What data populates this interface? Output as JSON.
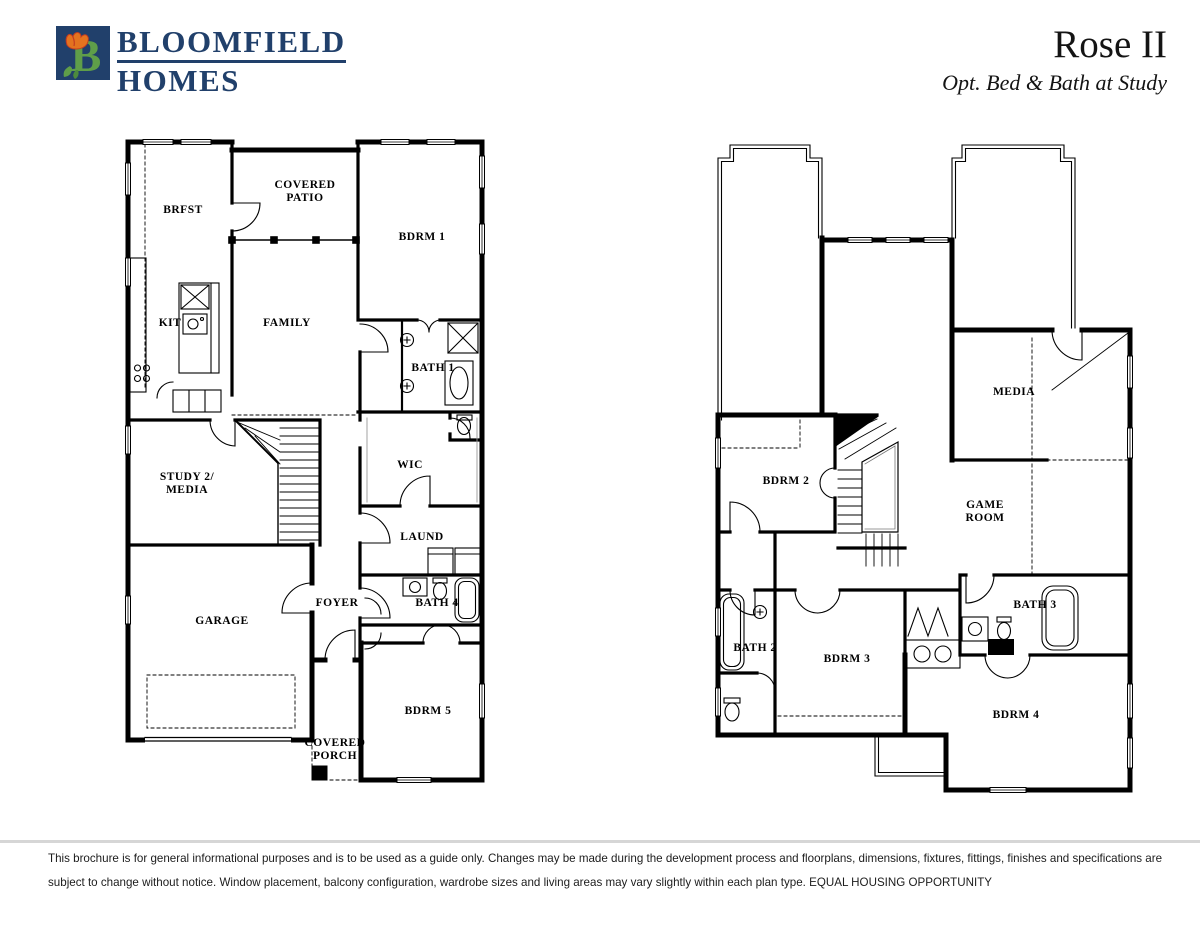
{
  "header": {
    "brand": {
      "line1": "BLOOMFIELD",
      "line2": "HOMES"
    },
    "title": "Rose II",
    "subtitle": "Opt. Bed & Bath at Study"
  },
  "plan1": {
    "rooms": {
      "brfst": "BRFST",
      "covered_patio_1": "COVERED",
      "covered_patio_2": "PATIO",
      "bdrm1": "BDRM 1",
      "kit": "KIT",
      "family": "FAMILY",
      "bath1": "BATH 1",
      "study_1": "STUDY 2/",
      "study_2": "MEDIA",
      "wic": "WIC",
      "laund": "LAUND",
      "foyer": "FOYER",
      "bath4": "BATH 4",
      "garage": "GARAGE",
      "bdrm5": "BDRM 5",
      "covered_porch_1": "COVERED",
      "covered_porch_2": "PORCH"
    }
  },
  "plan2": {
    "rooms": {
      "media": "MEDIA",
      "bdrm2": "BDRM 2",
      "game_room_1": "GAME",
      "game_room_2": "ROOM",
      "bath2": "BATH 2",
      "bdrm3": "BDRM 3",
      "bath3": "BATH 3",
      "bdrm4": "BDRM 4"
    }
  },
  "footer": {
    "disclaimer_line1": "This brochure is for general informational purposes and is to be used as a guide only. Changes may be made during the development process and floorplans, dimensions, fixtures, fittings, finishes and specifications are",
    "disclaimer_line2": "subject to change without notice. Window placement, balcony configuration, wardrobe sizes and living areas may vary slightly within each plan type.  EQUAL HOUSING OPPORTUNITY"
  },
  "colors": {
    "brand_navy": "#21406b",
    "leaf_green": "#5f9e49",
    "tulip_orange": "#e4731f",
    "line_black": "#000000"
  }
}
